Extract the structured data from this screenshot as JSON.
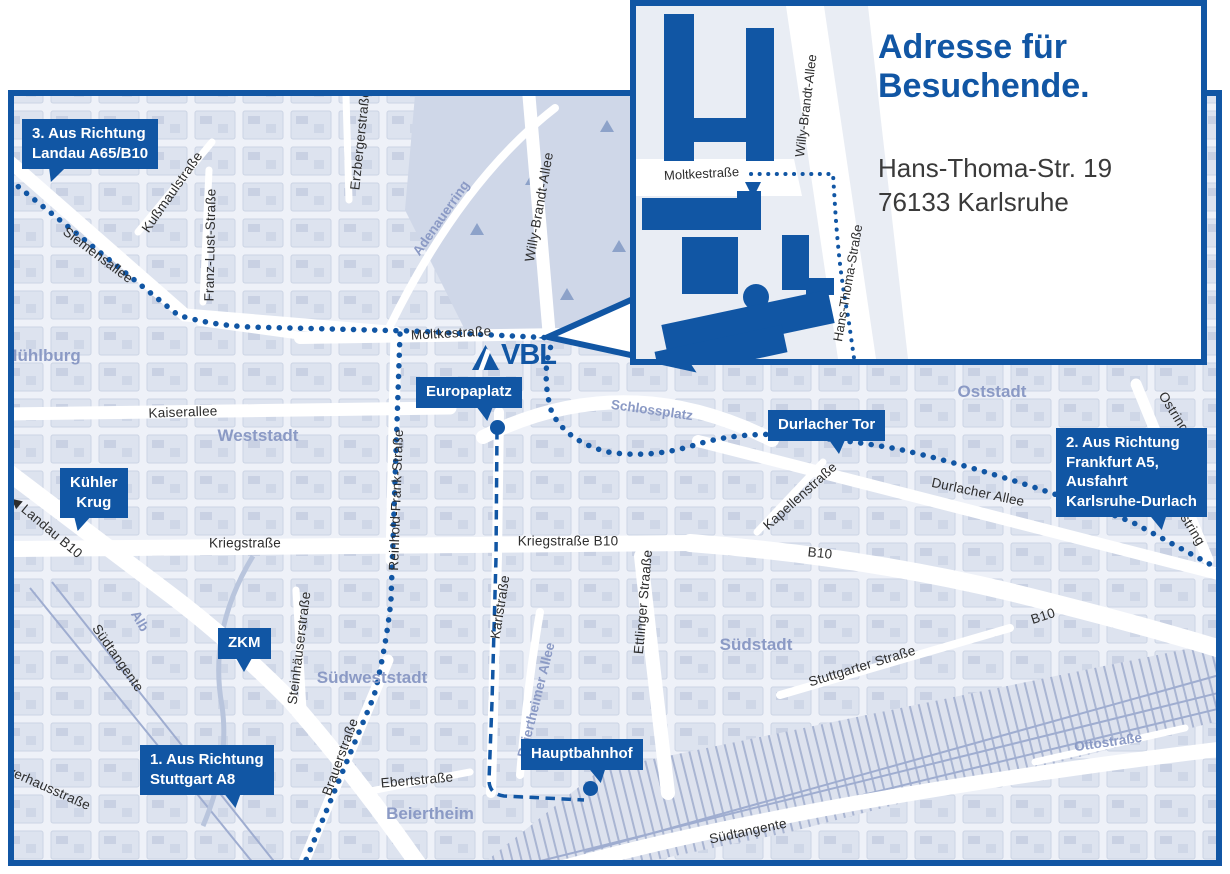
{
  "colors": {
    "brand_blue": "#1156a4",
    "map_background": "#eef1f8",
    "block_fill": "#dde3ef",
    "park_fill": "#cfd7e8",
    "district_text": "#8b9ac5",
    "street_text": "#2d2d2d",
    "address_text": "#3a3a3a"
  },
  "logo": {
    "text": "VBL"
  },
  "inset": {
    "title_line1": "Adresse für",
    "title_line2": "Besuchende.",
    "address_line1": "Hans-Thoma-Str. 19",
    "address_line2": "76133 Karlsruhe",
    "streets": {
      "moltkestrasse": "Moltkestraße",
      "willy_brandt": "Willy-Brandt-Allee",
      "hans_thoma": "Hans-Thoma-Straße"
    }
  },
  "callouts": [
    {
      "id": "landau",
      "lines": [
        "3. Aus Richtung",
        "Landau A65/B10"
      ]
    },
    {
      "id": "frankfurt",
      "lines": [
        "2. Aus Richtung",
        "Frankfurt A5,",
        "Ausfahrt",
        "Karlsruhe-Durlach"
      ]
    },
    {
      "id": "stuttgart",
      "lines": [
        "1. Aus Richtung",
        "Stuttgart A8"
      ]
    },
    {
      "id": "kuehler-krug",
      "lines": [
        "Kühler",
        "Krug"
      ]
    },
    {
      "id": "zkm",
      "lines": [
        "ZKM"
      ]
    },
    {
      "id": "europaplatz",
      "lines": [
        "Europaplatz"
      ]
    },
    {
      "id": "durlacher-tor",
      "lines": [
        "Durlacher Tor"
      ]
    },
    {
      "id": "hauptbahnhof",
      "lines": [
        "Hauptbahnhof"
      ]
    }
  ],
  "street_labels": {
    "siemensallee": "Siemensallee",
    "kussmaulstrasse": "Kußmaulstraße",
    "franz_lust": "Franz-Lust-Straße",
    "erzbergerstrasse": "Erzbergerstraße",
    "willy_brandt": "Willy-Brandt-Allee",
    "moltkestrasse": "Moltkestraße",
    "kaiserallee": "Kaiserallee",
    "reinhold_frank": "Reinhold-Frank-Straße",
    "kriegstrasse": "Kriegstraße",
    "kriegstrasse_b10": "Kriegstraße B10",
    "b10": "B10",
    "landau_b10": "◀ Landau B10",
    "durlacher_allee": "Durlacher Allee",
    "kapellenstrasse": "Kapellenstraße",
    "ostring": "Ostring",
    "stuttgarter_strasse": "Stuttgarter Straße",
    "ettlinger_strasse": "Ettlinger Straaße",
    "karlstrasse": "Karlstraße",
    "steinhaeuserstrasse": "Steinhäuserstraße",
    "brauerstrasse": "Brauerstraße",
    "ebertstrasse": "Ebertstraße",
    "suedtangente": "Südtangente",
    "pulverhausstrasse": "Pulverhausstraße"
  },
  "area_labels": {
    "adenauerring": "Adenauerring",
    "schlossplatz": "Schlossplatz",
    "alb": "Alb",
    "beiertheimer_allee": "Beiertheimer Allee",
    "ottostrasse": "Ottostraße"
  },
  "districts": {
    "muehlburg": "Mühlburg",
    "weststadt": "Weststadt",
    "oststadt": "Oststadt",
    "suedstadt": "Südstadt",
    "suedweststadt": "Südweststadt",
    "beiertheim": "Beiertheim"
  }
}
